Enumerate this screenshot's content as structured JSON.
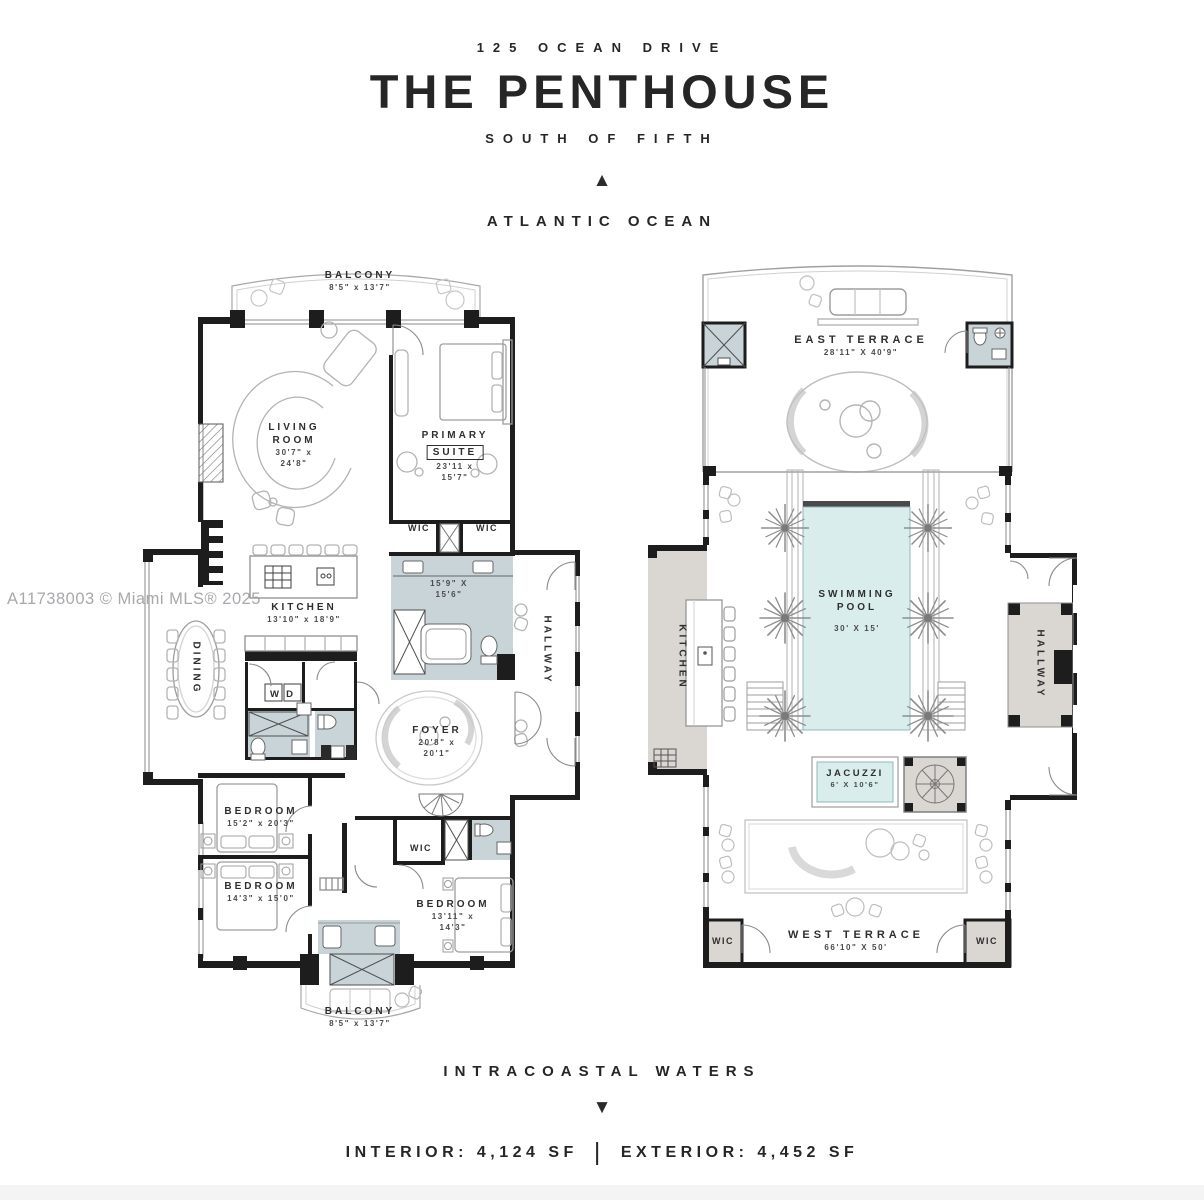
{
  "header": {
    "address": "125 OCEAN DRIVE",
    "title": "THE PENTHOUSE",
    "subtitle": "SOUTH OF FIFTH",
    "north_label": "ATLANTIC OCEAN"
  },
  "icons": {
    "north_marker": "▲",
    "south_marker": "▼"
  },
  "watermark": "A11738003 © Miami MLS® 2025",
  "footer": {
    "south_label": "INTRACOASTAL WATERS",
    "interior": "INTERIOR: 4,124 SF",
    "separator": "|",
    "exterior": "EXTERIOR: 4,452 SF"
  },
  "colors": {
    "ink": "#262626",
    "bath": "#c9d4d8",
    "pool": "#d9edec",
    "terrace": "#dad7d2",
    "line": "#9f9f9f"
  },
  "plans": {
    "left": {
      "rooms": {
        "balcony_north": {
          "lines": [
            "BALCONY",
            "8'5\" x 13'7\""
          ]
        },
        "living_room": {
          "lines": [
            "LIVING",
            "ROOM",
            "30'7\" x",
            "24'8\""
          ]
        },
        "primary_suite": {
          "lines": [
            "PRIMARY",
            "SUITE",
            "23'11 x",
            "15'7\""
          ]
        },
        "wic_left": {
          "lines": [
            "WIC"
          ]
        },
        "wic_right": {
          "lines": [
            "WIC"
          ]
        },
        "primary_bath": {
          "lines": [
            "15'9\" X",
            "15'6\""
          ]
        },
        "hallway": {
          "lines": [
            "HALLWAY"
          ]
        },
        "kitchen": {
          "lines": [
            "KITCHEN",
            "13'10\" x 18'9\""
          ]
        },
        "dining": {
          "lines": [
            "DINING"
          ]
        },
        "laundry": {
          "lines": [
            "W",
            "D"
          ]
        },
        "foyer": {
          "lines": [
            "FOYER",
            "20'8\" x",
            "20'1\""
          ]
        },
        "bedroom_1": {
          "lines": [
            "BEDROOM",
            "15'2\" x 20'3\""
          ]
        },
        "bedroom_2": {
          "lines": [
            "BEDROOM",
            "14'3\" x 15'0\""
          ]
        },
        "wic_3": {
          "lines": [
            "WIC"
          ]
        },
        "bedroom_3": {
          "lines": [
            "BEDROOM",
            "13'11\" x",
            "14'3\""
          ]
        },
        "balcony_south": {
          "lines": [
            "BALCONY",
            "8'5\" x 13'7\""
          ]
        }
      }
    },
    "right": {
      "rooms": {
        "east_terrace": {
          "lines": [
            "EAST TERRACE",
            "28'11\" X 40'9\""
          ]
        },
        "swimming_pool": {
          "lines": [
            "SWIMMING",
            "POOL",
            "30' X 15'"
          ]
        },
        "kitchen": {
          "lines": [
            "KITCHEN"
          ]
        },
        "hallway": {
          "lines": [
            "HALLWAY"
          ]
        },
        "jacuzzi": {
          "lines": [
            "JACUZZI",
            "6' X 10'6\""
          ]
        },
        "west_terrace": {
          "lines": [
            "WEST TERRACE",
            "66'10\" X 50'"
          ]
        },
        "wic_left": {
          "lines": [
            "WIC"
          ]
        },
        "wic_right": {
          "lines": [
            "WIC"
          ]
        }
      }
    }
  }
}
